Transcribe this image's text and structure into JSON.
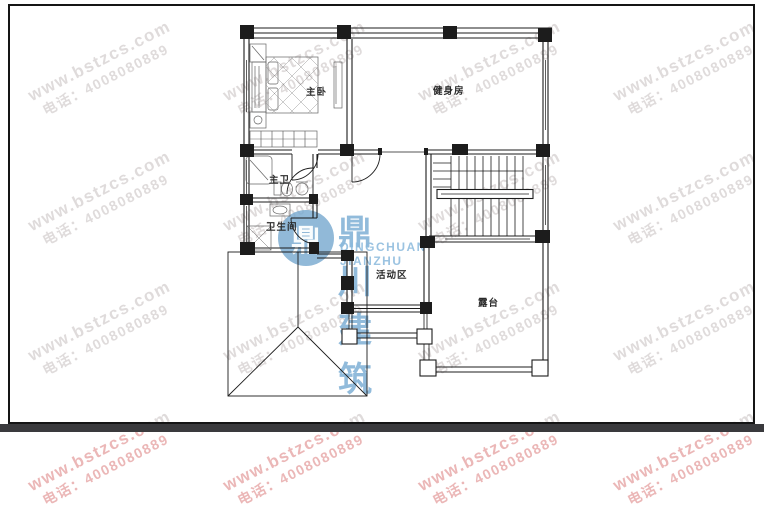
{
  "watermark": {
    "site": "www.bstzcs.com",
    "phone": "电话：4008080889"
  },
  "logo": {
    "name_cn": "鼎川建筑",
    "name_en": "DINGCHUAN JIANZHU",
    "mark_glyph": "鼎"
  },
  "rooms": {
    "master_bedroom": "主卧",
    "gym": "健身房",
    "master_bath": "主卫",
    "toilet": "卫生间",
    "activity_area": "活动区",
    "terrace": "露台"
  },
  "colors": {
    "logo_blue": "#76a8ce",
    "watermark_gray_rgba": "rgba(150,136,136,0.30)",
    "watermark_red_rgba": "rgba(219,124,124,0.55)",
    "line_black": "#1c1c1c",
    "bottom_bar": "#3a3a3d",
    "paper": "#ffffff"
  }
}
